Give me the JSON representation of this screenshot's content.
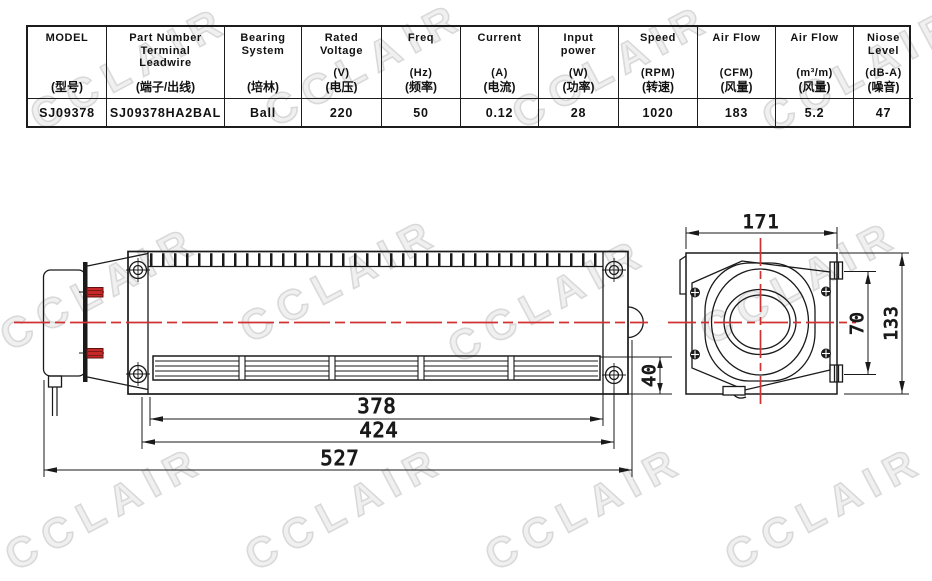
{
  "watermark": {
    "text": "CCLAIR"
  },
  "spec_table": {
    "columns": [
      {
        "en": "MODEL",
        "unit": "",
        "cn": "(型号)",
        "value": "SJ09378"
      },
      {
        "en": "Part Number\nTerminal\nLeadwire",
        "unit": "",
        "cn": "(端子/出线)",
        "value": "SJ09378HA2BAL"
      },
      {
        "en": "Bearing\nSystem",
        "unit": "",
        "cn": "(培林)",
        "value": "Ball"
      },
      {
        "en": "Rated\nVoltage",
        "unit": "(V)",
        "cn": "(电压)",
        "value": "220"
      },
      {
        "en": "Freq",
        "unit": "(Hz)",
        "cn": "(频率)",
        "value": "50"
      },
      {
        "en": "Current",
        "unit": "(A)",
        "cn": "(电流)",
        "value": "0.12"
      },
      {
        "en": "Input\npower",
        "unit": "(W)",
        "cn": "(功率)",
        "value": "28"
      },
      {
        "en": "Speed",
        "unit": "(RPM)",
        "cn": "(转速)",
        "value": "1020"
      },
      {
        "en": "Air Flow",
        "unit": "(CFM)",
        "cn": "(风量)",
        "value": "183"
      },
      {
        "en": "Air Flow",
        "unit": "(m³/m)",
        "cn": "(风量)",
        "value": "5.2"
      },
      {
        "en": "Niose\nLevel",
        "unit": "(dB-A)",
        "cn": "(噪音)",
        "value": "47"
      }
    ]
  },
  "drawing": {
    "side_view": {
      "width_378": "378",
      "width_424": "424",
      "width_527": "527",
      "height_40": "40"
    },
    "end_view": {
      "width_171": "171",
      "height_70": "70",
      "height_133": "133"
    },
    "colors": {
      "line": "#1a1a1a",
      "centerline": "#d03232",
      "terminal_pin": "#c62828"
    }
  }
}
